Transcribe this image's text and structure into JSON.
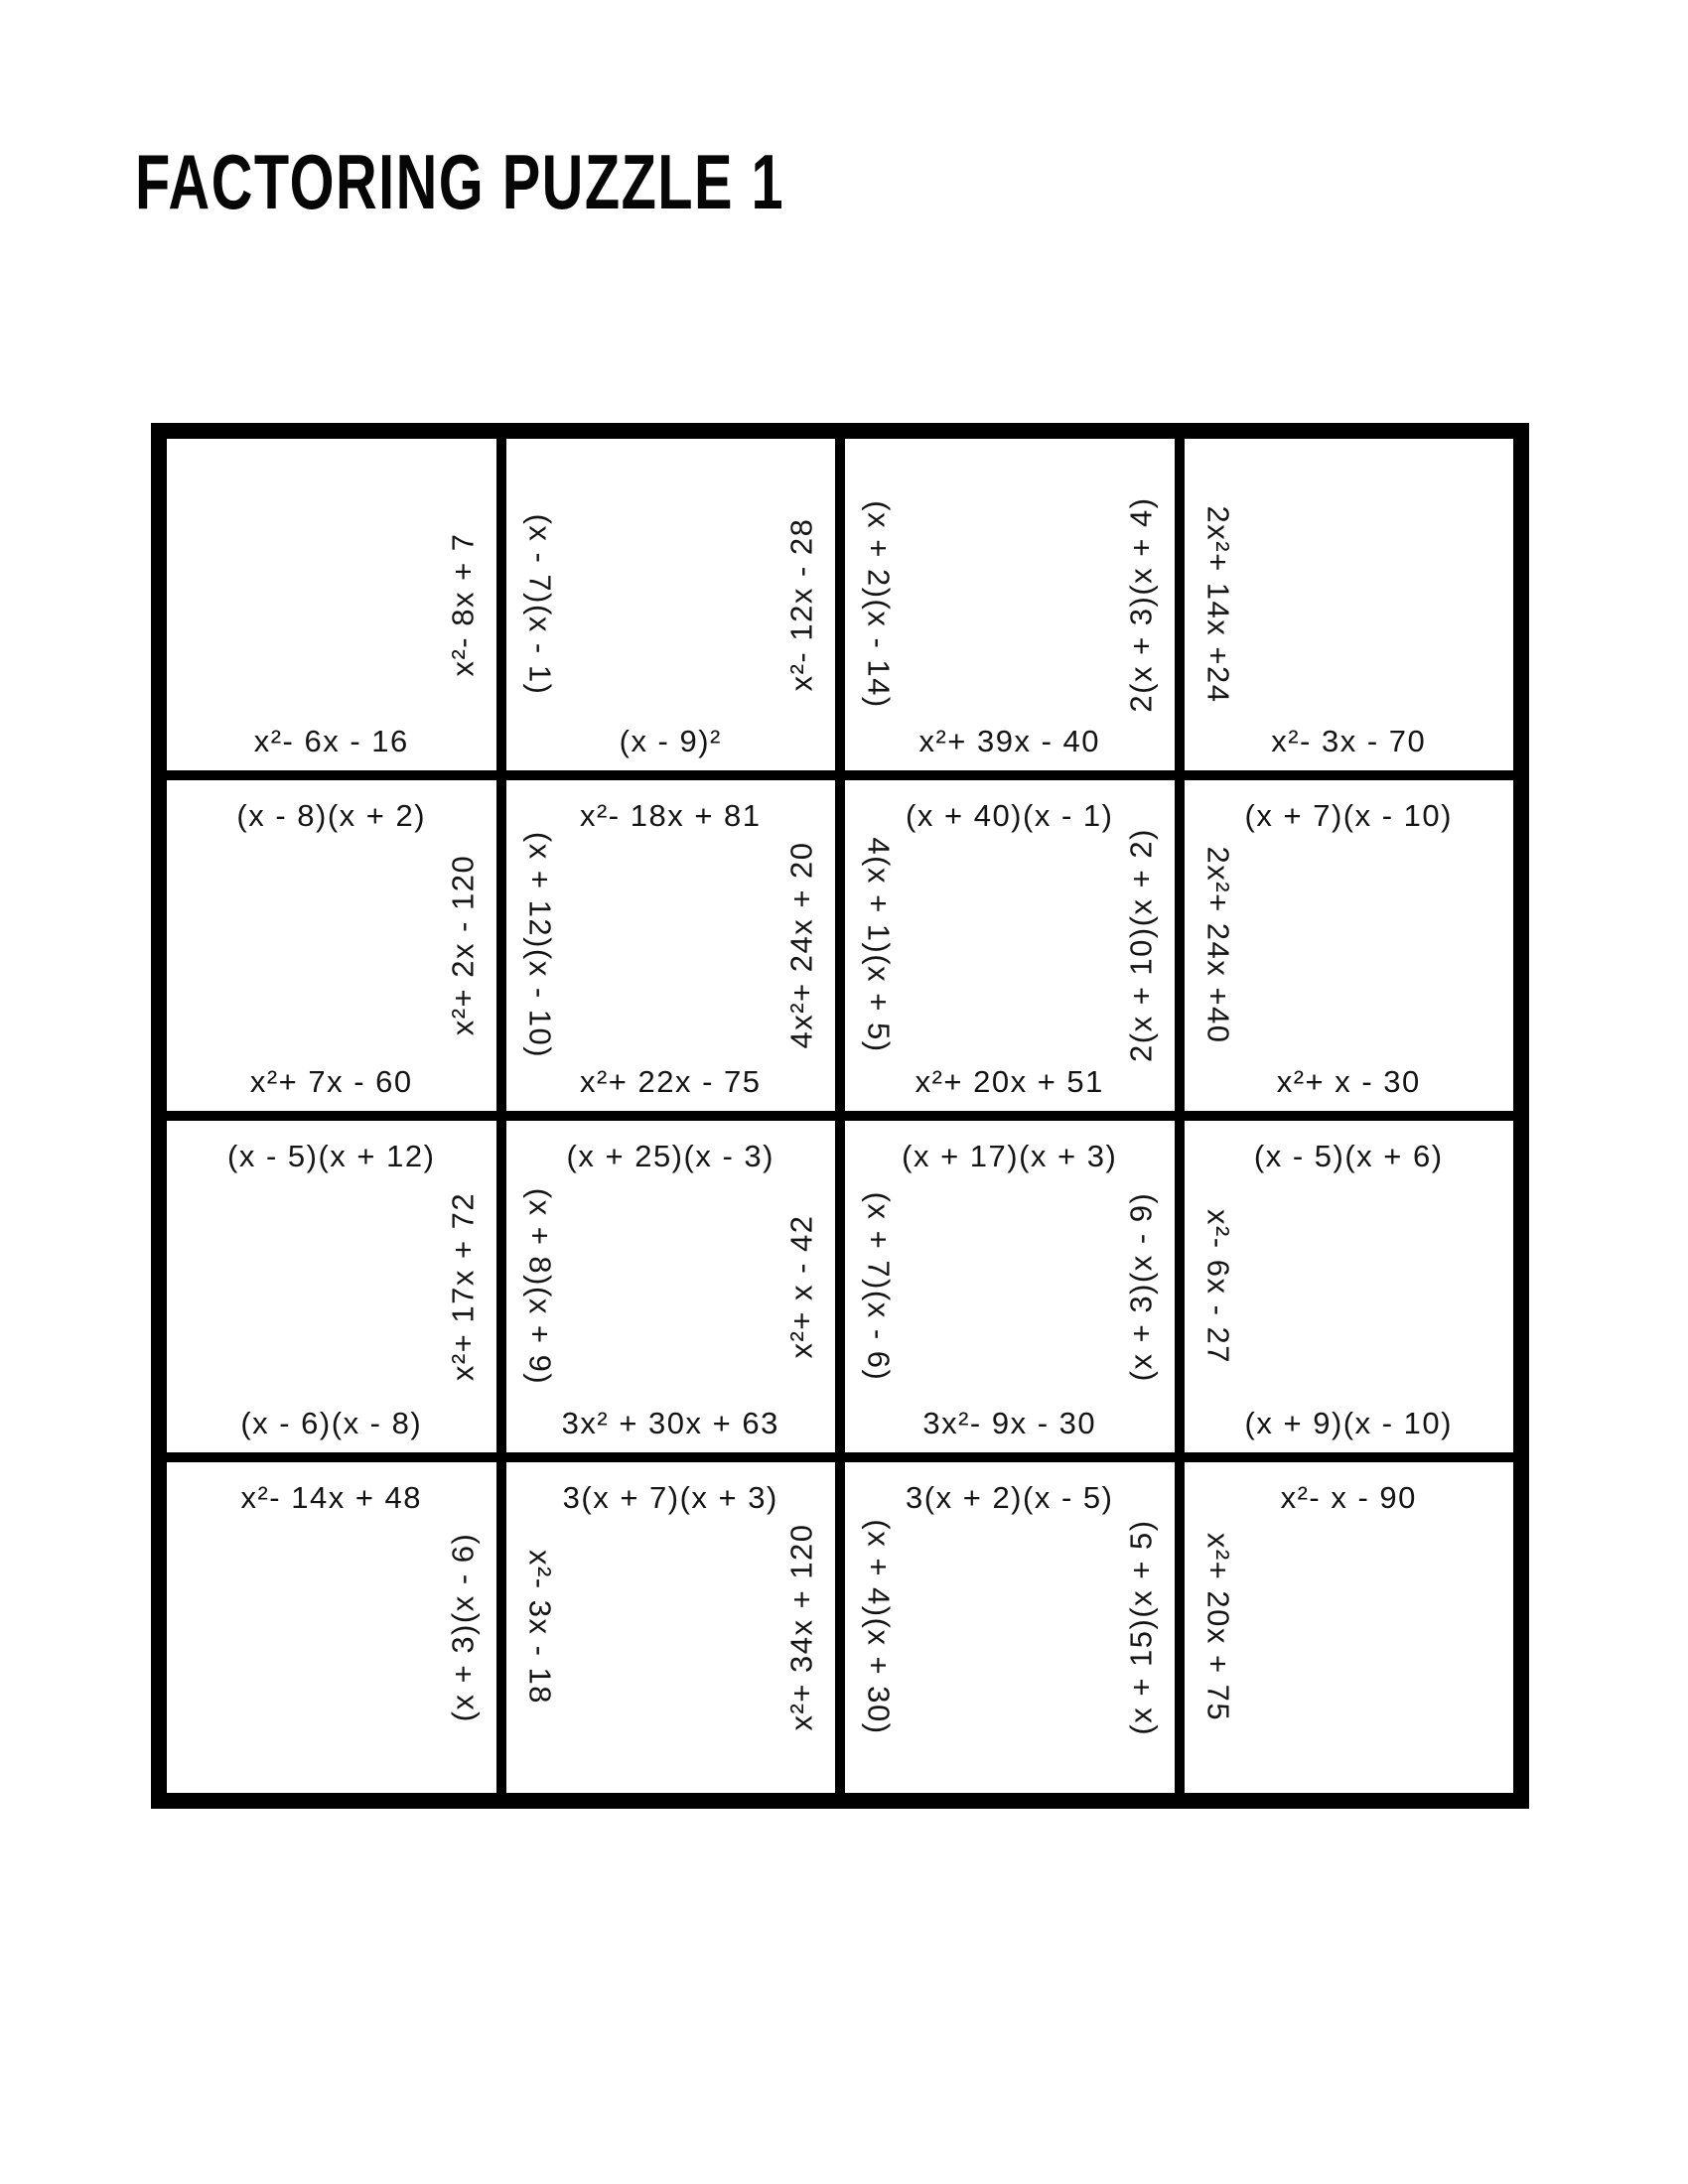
{
  "title": "FACTORING PUZZLE 1",
  "ink_color": "#000000",
  "grid": {
    "rows": 4,
    "columns": 4
  },
  "cells": [
    {
      "top": "",
      "left": "",
      "right": "x²- 8x + 7",
      "bottom": "x²- 6x - 16"
    },
    {
      "top": "",
      "left": "(x - 7)(x - 1)",
      "right": "x²- 12x - 28",
      "bottom": "(x - 9)²"
    },
    {
      "top": "",
      "left": "(x + 2)(x - 14)",
      "right": "2(x + 3)(x + 4)",
      "bottom": "x²+ 39x - 40"
    },
    {
      "top": "",
      "left": "2x²+ 14x +24",
      "right": "",
      "bottom": "x²- 3x - 70"
    },
    {
      "top": "(x - 8)(x + 2)",
      "left": "",
      "right": "x²+ 2x - 120",
      "bottom": "x²+ 7x - 60"
    },
    {
      "top": "x²- 18x + 81",
      "left": "(x + 12)(x - 10)",
      "right": "4x²+ 24x + 20",
      "bottom": "x²+ 22x - 75"
    },
    {
      "top": "(x + 40)(x - 1)",
      "left": "4(x + 1)(x + 5)",
      "right": "2(x + 10)(x + 2)",
      "bottom": "x²+ 20x + 51"
    },
    {
      "top": "(x + 7)(x - 10)",
      "left": "2x²+ 24x +40",
      "right": "",
      "bottom": "x²+ x - 30"
    },
    {
      "top": "(x - 5)(x + 12)",
      "left": "",
      "right": "x²+ 17x + 72",
      "bottom": "(x - 6)(x - 8)"
    },
    {
      "top": "(x + 25)(x - 3)",
      "left": "(x + 8)(x + 9)",
      "right": "x²+ x - 42",
      "bottom": "3x² + 30x + 63"
    },
    {
      "top": "(x + 17)(x + 3)",
      "left": "(x + 7)(x - 6)",
      "right": "(x + 3)(x - 9)",
      "bottom": "3x²- 9x - 30"
    },
    {
      "top": "(x - 5)(x + 6)",
      "left": "x²- 6x - 27",
      "right": "",
      "bottom": "(x + 9)(x - 10)"
    },
    {
      "top": "x²- 14x + 48",
      "left": "",
      "right": "(x + 3)(x - 6)",
      "bottom": ""
    },
    {
      "top": "3(x + 7)(x + 3)",
      "left": "x²- 3x - 18",
      "right": "x²+ 34x + 120",
      "bottom": ""
    },
    {
      "top": "3(x + 2)(x - 5)",
      "left": "(x + 4)(x + 30)",
      "right": "(x + 15)(x + 5)",
      "bottom": ""
    },
    {
      "top": "x²- x - 90",
      "left": "x²+ 20x + 75",
      "right": "",
      "bottom": ""
    }
  ]
}
